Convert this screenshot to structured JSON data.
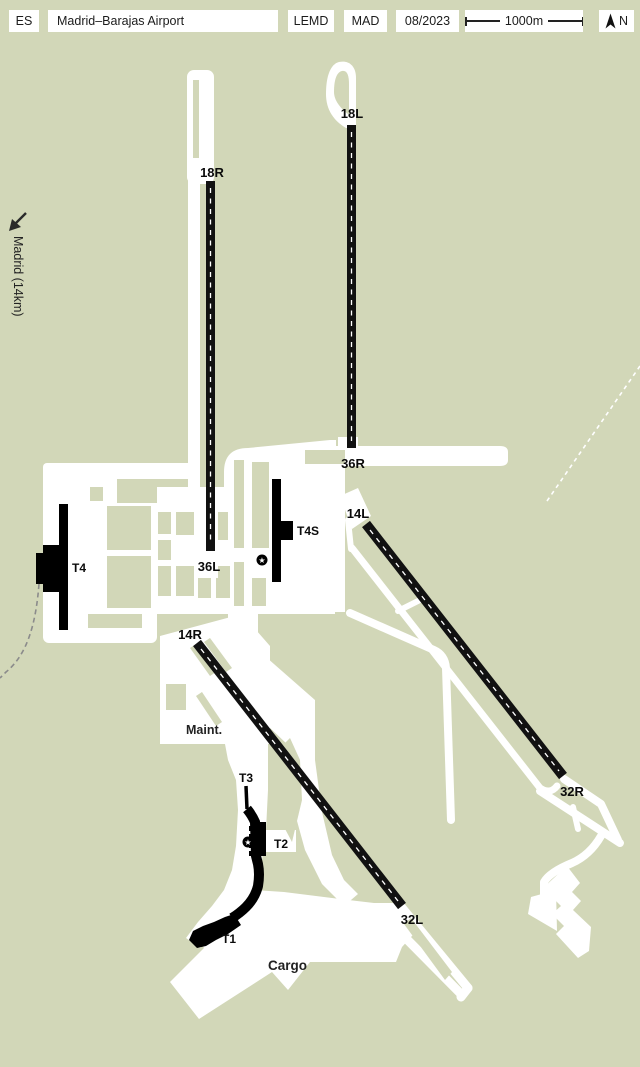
{
  "header": {
    "country_code": "ES",
    "airport_name": "Madrid–Barajas Airport",
    "icao_code": "LEMD",
    "iata_code": "MAD",
    "date": "08/2023",
    "scale_label": "1000m",
    "north_label": "N"
  },
  "map": {
    "colors": {
      "background": "#d2d7b8",
      "pavement": "#ffffff",
      "runway": "#111111",
      "building": "#000000",
      "road_dashed": "#8b8b8b"
    },
    "offsite_label": "Madrid (14km)",
    "runway_ends": {
      "r18R": "18R",
      "r18L": "18L",
      "r36L": "36L",
      "r36R": "36R",
      "r14L": "14L",
      "r14R": "14R",
      "r32L": "32L",
      "r32R": "32R"
    },
    "terminals": {
      "t4": "T4",
      "t4s": "T4S",
      "t3": "T3",
      "t2": "T2",
      "t1": "T1"
    },
    "areas": {
      "maintenance": "Maint.",
      "cargo": "Cargo"
    },
    "markers": {
      "star": "★"
    }
  }
}
